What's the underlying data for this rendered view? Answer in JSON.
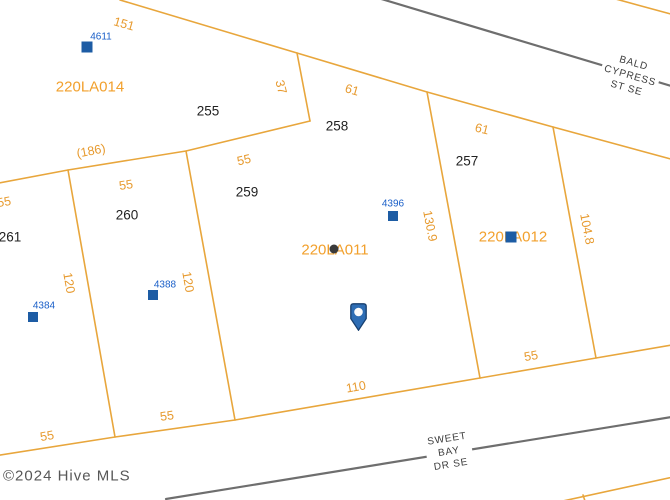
{
  "streets": {
    "bald_cypress": {
      "line1": "BALD",
      "line2": "CYPRESS",
      "line3": "ST SE"
    },
    "sweet_bay": {
      "line1": "SWEET",
      "line2": "BAY",
      "line3": "DR SE"
    }
  },
  "parcels": {
    "p220la014": "220LA014",
    "p220la011": "220LA011",
    "p220la012": "220LA012"
  },
  "lots": {
    "lot255": "255",
    "lot258": "258",
    "lot257": "257",
    "lot259": "259",
    "lot260": "260",
    "lot261": "261"
  },
  "dimensions": {
    "d151": "151",
    "d37": "37",
    "d61a": "61",
    "d61b": "61",
    "d186": "(186)",
    "d55_edge": "55",
    "d55_260top": "55",
    "d55_259top": "55",
    "d120_261": "120",
    "d120_260": "120",
    "d130_9": "130.9",
    "d104_8": "104.8",
    "d55_261bot": "55",
    "d55_260bot": "55",
    "d110": "110",
    "d55_012bot": "55"
  },
  "addresses": {
    "a4611": "4611",
    "a4396": "4396",
    "a4388": "4388",
    "a4384": "4384"
  },
  "footer": {
    "copyright": "©2024 Hive MLS"
  },
  "colors": {
    "boundary": "#E8A63C",
    "dimension_text": "#E79A2E",
    "parcel_text": "#F2A02C",
    "lot_text": "#222222",
    "road": "#6E6E6E",
    "street_text": "#3C3C3C",
    "address_blue": "#1A5FC8",
    "marker_blue": "#1D5CA4",
    "pin_blue": "#2E6DB4",
    "pin_outline": "#173F6F"
  }
}
